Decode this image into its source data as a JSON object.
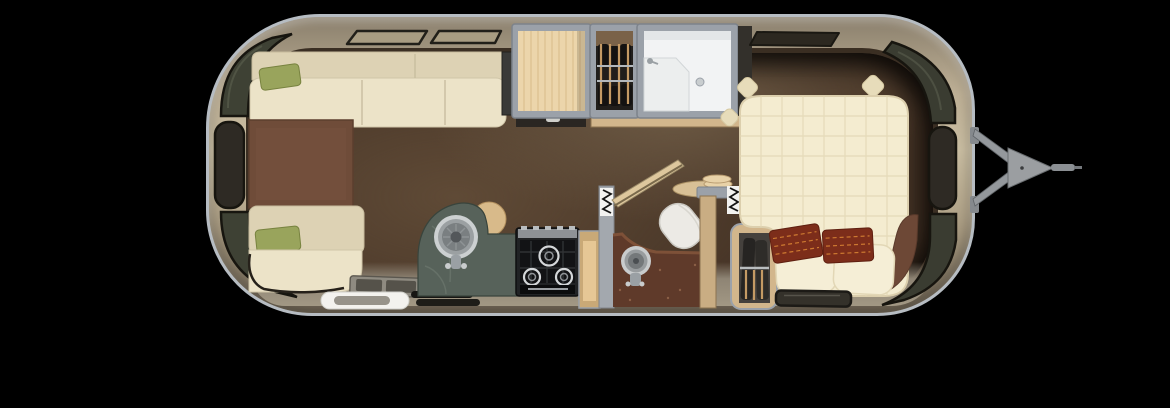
{
  "canvas": {
    "background": "#000000",
    "width": 1170,
    "height": 408
  },
  "colors": {
    "bg": "#000000",
    "rim": "#b6bcc2",
    "frame": "#9ba1a9",
    "frameDark": "#7d838b",
    "glass": "#2e2a24",
    "glassGreen": "#3e4134",
    "outline": "#17150f",
    "cream": "#ece3c8",
    "creamLight": "#f5eed6",
    "creamDark": "#ddd2b4",
    "green": "#99a45c",
    "rug": "#6f4c39",
    "rust": "#7c2d1a",
    "rustLine": "#ce7a31",
    "marble": "#57625a",
    "wood": "#ecd5ab",
    "woodGrain": "#d4b583",
    "tan": "#d2b68c",
    "tanDark": "#a98f63",
    "white": "#f2f3f4",
    "steel": "#9aa0a4",
    "steelLight": "#c9cccd",
    "darkCloth": "#211e1b",
    "hanger": "#c49a64",
    "hitch": "#94989c",
    "hitchDark": "#6a6e71",
    "bedGrid": "#e2d7b4",
    "roll": "#6d4836",
    "toiletCounter": "#5f3a2a",
    "doorWhite": "#f3f2ee",
    "stepGray": "#8f8b81"
  },
  "inventory": {
    "rear_lounge": [
      "wraparound-sofa",
      "green-throw-pillow",
      "green-throw-pillow",
      "brown-ottoman-table"
    ],
    "entry": [
      "entry-steps",
      "entry-door",
      "door-mats"
    ],
    "galley": [
      "marble-countertop",
      "round-sink",
      "faucet",
      "three-burner-cooktop",
      "open-shelf-cabinet",
      "overhead-wood-cabinet",
      "under-cabinet-drawer"
    ],
    "wardrobe_mid": [
      "hanging-rods",
      "clothes-hangers",
      "garments"
    ],
    "bathroom": [
      "shower-room",
      "vanity-counter",
      "shower-drain",
      "faucet"
    ],
    "toilet_room": [
      "speckled-counter",
      "vessel-sink",
      "faucet",
      "toilet",
      "privacy-door",
      "corner-shelf",
      "plate-stack",
      "accordion-door-symbol",
      "accordion-door-symbol"
    ],
    "bedroom": [
      "queen-bed",
      "quilted-mattress",
      "cream-pillow",
      "cream-pillow",
      "rust-accent-pillow",
      "rust-accent-pillow",
      "blanket-roll",
      "front-wardrobe"
    ],
    "shell": [
      "rear-corner-window",
      "rear-side-window",
      "rear-lower-corner-window",
      "roof-window",
      "roof-window",
      "front-roof-window",
      "front-corner-window",
      "front-side-window",
      "front-lower-corner-window",
      "street-side-window"
    ],
    "exterior": [
      "tow-hitch-a-frame",
      "hitch-coupler",
      "hitch-tongue"
    ]
  }
}
